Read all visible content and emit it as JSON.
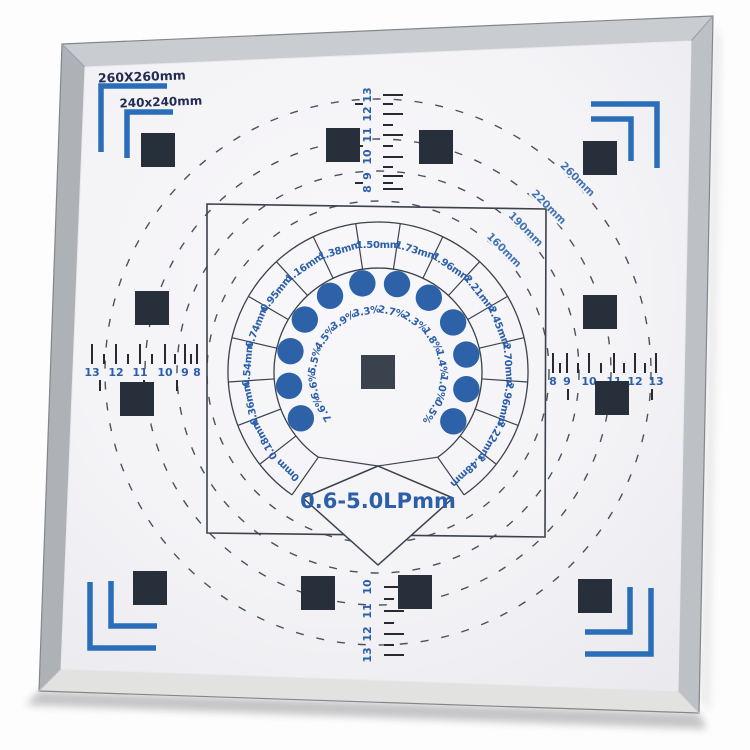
{
  "board": {
    "size_label_outer": "260X260mm",
    "size_label_inner": "240x240mm",
    "center_diamond_label": "0.6-5.0LPmm"
  },
  "circles": {
    "labels": [
      "260mm",
      "220mm",
      "190mm",
      "160mm"
    ]
  },
  "fan": {
    "mm_labels": [
      "0mm",
      "0.18mm",
      "0.36mm",
      "0.54mm",
      "0.74mm",
      "0.95mm",
      "1.16mm",
      "1.38mm",
      "1.50mm",
      "1.73mm",
      "1.96mm",
      "2.21mm",
      "2.45mm",
      "2.70mm",
      "2.96mm",
      "3.22mm",
      "3.48mm"
    ],
    "percent_labels": [
      "7.6%",
      "6.6%",
      "5.5%",
      "4.5%",
      "3.9%",
      "3.3%",
      "2.7%",
      "2.3%",
      "1.8%",
      "1.4%",
      "1.0%",
      "0.5%"
    ],
    "dot_count": 12
  },
  "rulers": {
    "top": [
      "13",
      "12",
      "11",
      "10",
      "9",
      "8"
    ],
    "bottom": [
      "10",
      "11",
      "12",
      "13"
    ],
    "left": [
      "13",
      "12",
      "11",
      "10",
      "9",
      "8"
    ],
    "right": [
      "8",
      "9",
      "10",
      "11",
      "12",
      "13"
    ]
  },
  "colors": {
    "blue_marking": "#2a6db8",
    "blue_text": "#2c5fa9",
    "navy_text": "#232c52",
    "circle_label_blue": "#4273b4",
    "dot_blue": "#2d62a9",
    "line_dark": "#3b424c",
    "dash_gray": "#4a525d",
    "tick_dark": "#272b31",
    "square_dark": "#272f3b",
    "square_center": "#3a424d",
    "board_white": "#f5f4f7"
  }
}
